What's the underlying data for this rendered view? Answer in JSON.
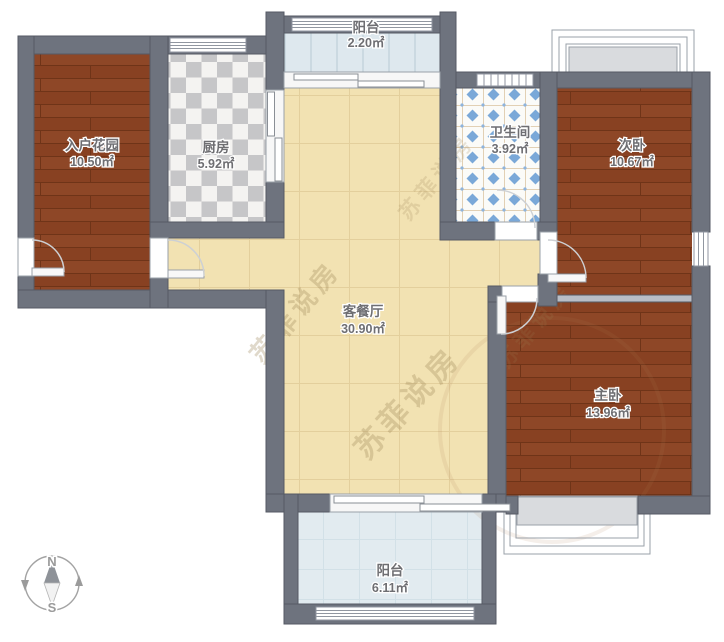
{
  "title": "户型图",
  "rooms": [
    {
      "id": "entry-garden",
      "name": "入户花园",
      "area": "10.50㎡"
    },
    {
      "id": "kitchen",
      "name": "厨房",
      "area": "5.92㎡"
    },
    {
      "id": "balcony-top",
      "name": "阳台",
      "area": "2.20㎡"
    },
    {
      "id": "bathroom",
      "name": "卫生间",
      "area": "3.92㎡"
    },
    {
      "id": "bedroom-second",
      "name": "次卧",
      "area": "10.67㎡"
    },
    {
      "id": "living-dining",
      "name": "客餐厅",
      "area": "30.90㎡"
    },
    {
      "id": "bedroom-master",
      "name": "主卧",
      "area": "13.96㎡"
    },
    {
      "id": "balcony-bottom",
      "name": "阳台",
      "area": "6.11㎡"
    }
  ],
  "compass": {
    "north_label": "N",
    "south_label": "S"
  },
  "watermark": {
    "text": "苏菲说房"
  },
  "colors": {
    "wall": "#6e737e",
    "wood_floor": "#8e4727",
    "living_floor": "#f2e2b2",
    "kitchen_tile_gray": "#c6c6c8",
    "bath_tile_blue": "#7aa8d8",
    "balcony_floor": "#e1eaef",
    "bay_window_fill": "#d9dbde",
    "label_text": "#6e6e72",
    "watermark_tint": "#9c8455"
  }
}
